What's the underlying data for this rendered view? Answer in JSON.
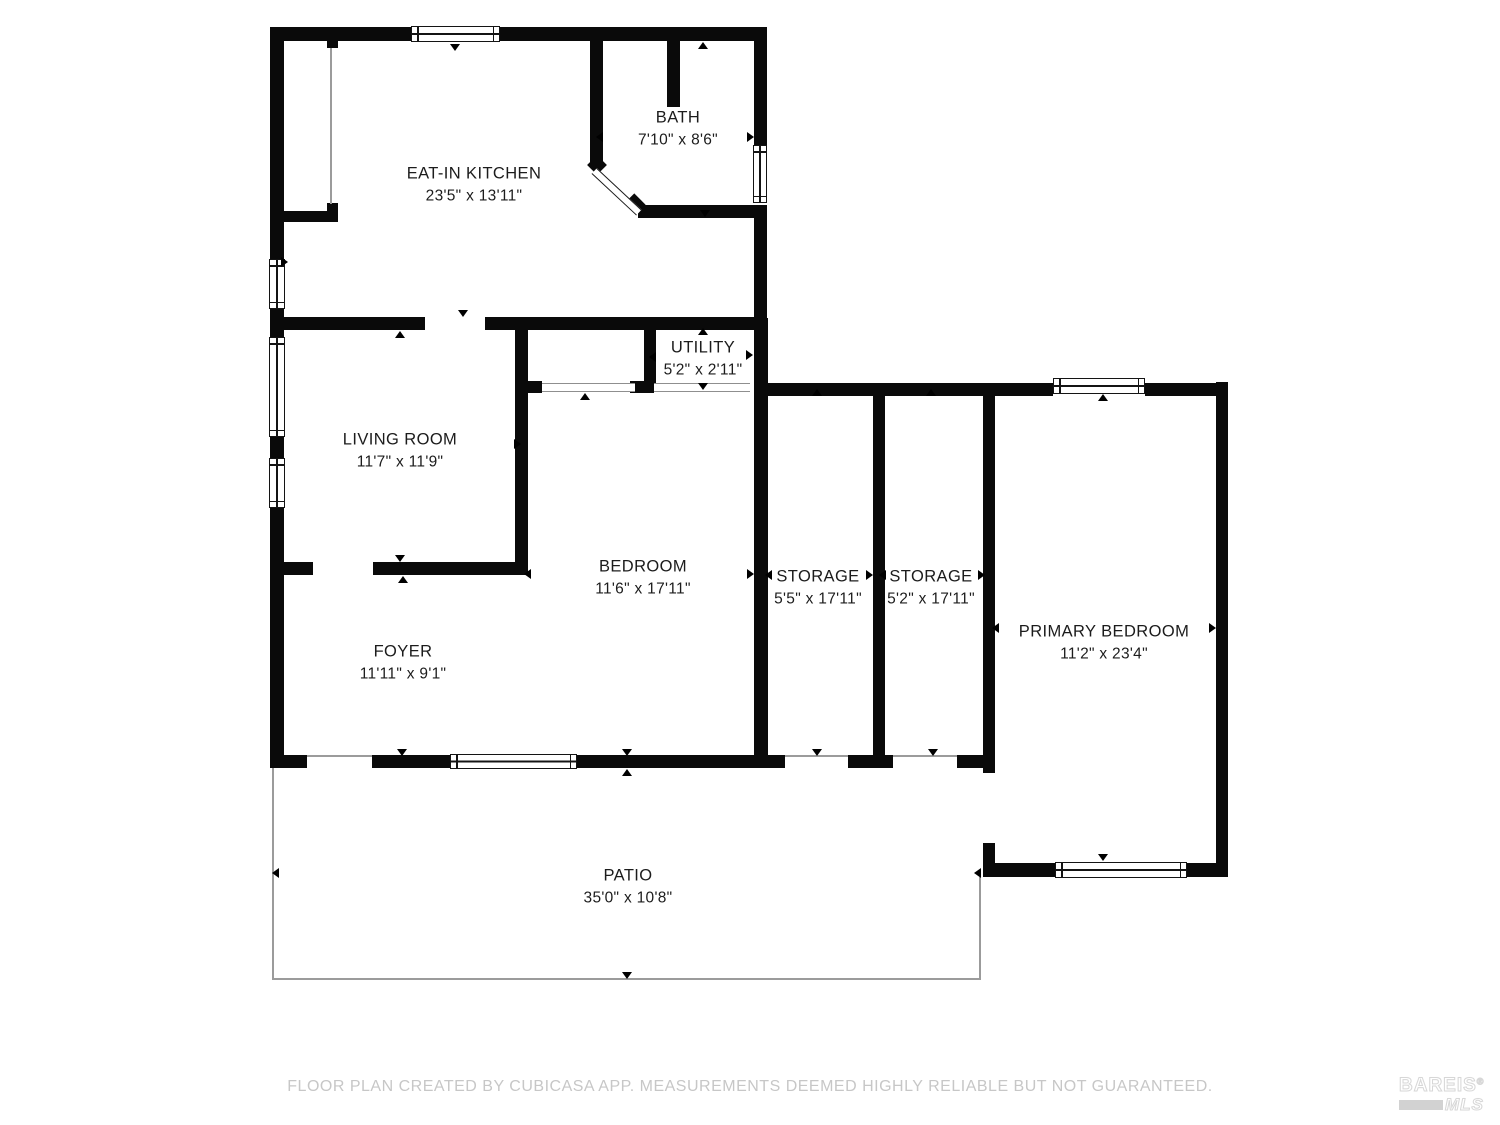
{
  "meta": {
    "width": 1500,
    "height": 1125,
    "background": "#ffffff",
    "wall_color": "#0a0a0a",
    "label_color": "#1c1c1c",
    "muted_line_color": "#9b9b9b",
    "footer_color": "#c7c7c7"
  },
  "rooms": [
    {
      "name": "EAT-IN KITCHEN",
      "dims": "23'5\" x 13'11\"",
      "cx": 474,
      "cy": 185
    },
    {
      "name": "BATH",
      "dims": "7'10\" x 8'6\"",
      "cx": 678,
      "cy": 129
    },
    {
      "name": "UTILITY",
      "dims": "5'2\" x 2'11\"",
      "cx": 703,
      "cy": 359
    },
    {
      "name": "LIVING ROOM",
      "dims": "11'7\" x 11'9\"",
      "cx": 400,
      "cy": 451
    },
    {
      "name": "BEDROOM",
      "dims": "11'6\" x 17'11\"",
      "cx": 643,
      "cy": 578
    },
    {
      "name": "STORAGE",
      "dims": "5'5\" x 17'11\"",
      "cx": 818,
      "cy": 588
    },
    {
      "name": "STORAGE",
      "dims": "5'2\" x 17'11\"",
      "cx": 931,
      "cy": 588
    },
    {
      "name": "PRIMARY BEDROOM",
      "dims": "11'2\" x 23'4\"",
      "cx": 1104,
      "cy": 643
    },
    {
      "name": "FOYER",
      "dims": "11'11\" x 9'1\"",
      "cx": 403,
      "cy": 663
    },
    {
      "name": "PATIO",
      "dims": "35'0\" x 10'8\"",
      "cx": 628,
      "cy": 887
    }
  ],
  "walls": [
    {
      "x": 270,
      "y": 27,
      "w": 497,
      "h": 14
    },
    {
      "x": 270,
      "y": 41,
      "w": 14,
      "h": 219
    },
    {
      "x": 270,
      "y": 307,
      "w": 14,
      "h": 11
    },
    {
      "x": 754,
      "y": 41,
      "w": 13,
      "h": 104
    },
    {
      "x": 754,
      "y": 205,
      "w": 13,
      "h": 113
    },
    {
      "x": 327,
      "y": 41,
      "w": 11,
      "h": 7
    },
    {
      "x": 327,
      "y": 203,
      "w": 11,
      "h": 9
    },
    {
      "x": 284,
      "y": 211,
      "w": 54,
      "h": 11
    },
    {
      "x": 590,
      "y": 41,
      "w": 13,
      "h": 127
    },
    {
      "x": 667,
      "y": 41,
      "w": 13,
      "h": 66
    },
    {
      "x": 638,
      "y": 205,
      "w": 116,
      "h": 13
    },
    {
      "x": 270,
      "y": 317,
      "w": 155,
      "h": 13
    },
    {
      "x": 485,
      "y": 317,
      "w": 269,
      "h": 13
    },
    {
      "x": 270,
      "y": 330,
      "w": 14,
      "h": 8
    },
    {
      "x": 270,
      "y": 435,
      "w": 14,
      "h": 23
    },
    {
      "x": 270,
      "y": 507,
      "w": 14,
      "h": 248
    },
    {
      "x": 515,
      "y": 330,
      "w": 13,
      "h": 245
    },
    {
      "x": 518,
      "y": 381,
      "w": 24,
      "h": 12
    },
    {
      "x": 630,
      "y": 381,
      "w": 24,
      "h": 12
    },
    {
      "x": 644,
      "y": 330,
      "w": 12,
      "h": 53
    },
    {
      "x": 754,
      "y": 318,
      "w": 14,
      "h": 450
    },
    {
      "x": 270,
      "y": 562,
      "w": 43,
      "h": 13
    },
    {
      "x": 373,
      "y": 562,
      "w": 144,
      "h": 13
    },
    {
      "x": 768,
      "y": 383,
      "w": 285,
      "h": 13
    },
    {
      "x": 1145,
      "y": 383,
      "w": 83,
      "h": 13
    },
    {
      "x": 873,
      "y": 390,
      "w": 12,
      "h": 378
    },
    {
      "x": 983,
      "y": 390,
      "w": 12,
      "h": 383
    },
    {
      "x": 983,
      "y": 843,
      "w": 12,
      "h": 34
    },
    {
      "x": 1216,
      "y": 382,
      "w": 12,
      "h": 495
    },
    {
      "x": 983,
      "y": 863,
      "w": 72,
      "h": 14
    },
    {
      "x": 1187,
      "y": 863,
      "w": 41,
      "h": 14
    },
    {
      "x": 270,
      "y": 755,
      "w": 37,
      "h": 13
    },
    {
      "x": 372,
      "y": 755,
      "w": 78,
      "h": 13
    },
    {
      "x": 577,
      "y": 755,
      "w": 208,
      "h": 13
    },
    {
      "x": 848,
      "y": 755,
      "w": 45,
      "h": 13
    },
    {
      "x": 957,
      "y": 755,
      "w": 36,
      "h": 13
    }
  ],
  "windows": [
    {
      "x": 411,
      "y": 26,
      "w": 89,
      "h": 16,
      "o": "h"
    },
    {
      "x": 753,
      "y": 145,
      "w": 14,
      "h": 58,
      "o": "v"
    },
    {
      "x": 269,
      "y": 259,
      "w": 16,
      "h": 50,
      "o": "v"
    },
    {
      "x": 269,
      "y": 337,
      "w": 16,
      "h": 100,
      "o": "v"
    },
    {
      "x": 269,
      "y": 458,
      "w": 16,
      "h": 50,
      "o": "v"
    },
    {
      "x": 450,
      "y": 754,
      "w": 127,
      "h": 15,
      "o": "h"
    },
    {
      "x": 1053,
      "y": 378,
      "w": 92,
      "h": 16,
      "o": "h"
    },
    {
      "x": 1055,
      "y": 862,
      "w": 132,
      "h": 16,
      "o": "h"
    }
  ],
  "openings": [
    {
      "x": 542,
      "y": 383,
      "w": 93,
      "h": 9
    },
    {
      "x": 654,
      "y": 383,
      "w": 96,
      "h": 9
    }
  ],
  "thin_lines": [
    {
      "x": 330,
      "y": 48,
      "w": 2,
      "h": 156
    },
    {
      "x": 307,
      "y": 755,
      "w": 65,
      "h": 2
    },
    {
      "x": 785,
      "y": 755,
      "w": 63,
      "h": 2
    },
    {
      "x": 893,
      "y": 755,
      "w": 64,
      "h": 2
    },
    {
      "x": 272,
      "y": 768,
      "w": 2,
      "h": 212
    },
    {
      "x": 272,
      "y": 978,
      "w": 709,
      "h": 2
    },
    {
      "x": 979,
      "y": 877,
      "w": 2,
      "h": 103
    }
  ],
  "arrows": [
    {
      "x": 455,
      "y": 47,
      "d": "down"
    },
    {
      "x": 703,
      "y": 45,
      "d": "up"
    },
    {
      "x": 599,
      "y": 137,
      "d": "left"
    },
    {
      "x": 750,
      "y": 137,
      "d": "right"
    },
    {
      "x": 705,
      "y": 213,
      "d": "down"
    },
    {
      "x": 284,
      "y": 262,
      "d": "right"
    },
    {
      "x": 463,
      "y": 313,
      "d": "down"
    },
    {
      "x": 400,
      "y": 334,
      "d": "up"
    },
    {
      "x": 517,
      "y": 444,
      "d": "right"
    },
    {
      "x": 400,
      "y": 558,
      "d": "down"
    },
    {
      "x": 403,
      "y": 579,
      "d": "up"
    },
    {
      "x": 527,
      "y": 574,
      "d": "left"
    },
    {
      "x": 750,
      "y": 574,
      "d": "right"
    },
    {
      "x": 585,
      "y": 396,
      "d": "up"
    },
    {
      "x": 652,
      "y": 357,
      "d": "left"
    },
    {
      "x": 749,
      "y": 355,
      "d": "right"
    },
    {
      "x": 703,
      "y": 331,
      "d": "up"
    },
    {
      "x": 703,
      "y": 386,
      "d": "down"
    },
    {
      "x": 768,
      "y": 575,
      "d": "left"
    },
    {
      "x": 869,
      "y": 575,
      "d": "right"
    },
    {
      "x": 817,
      "y": 392,
      "d": "up"
    },
    {
      "x": 882,
      "y": 575,
      "d": "left"
    },
    {
      "x": 981,
      "y": 575,
      "d": "right"
    },
    {
      "x": 931,
      "y": 392,
      "d": "up"
    },
    {
      "x": 995,
      "y": 628,
      "d": "left"
    },
    {
      "x": 1212,
      "y": 628,
      "d": "right"
    },
    {
      "x": 1103,
      "y": 397,
      "d": "up"
    },
    {
      "x": 1103,
      "y": 857,
      "d": "down"
    },
    {
      "x": 402,
      "y": 752,
      "d": "down"
    },
    {
      "x": 627,
      "y": 752,
      "d": "down"
    },
    {
      "x": 627,
      "y": 772,
      "d": "up"
    },
    {
      "x": 817,
      "y": 752,
      "d": "down"
    },
    {
      "x": 933,
      "y": 752,
      "d": "down"
    },
    {
      "x": 275,
      "y": 873,
      "d": "left"
    },
    {
      "x": 977,
      "y": 873,
      "d": "left"
    },
    {
      "x": 627,
      "y": 975,
      "d": "down"
    }
  ],
  "bath_door": {
    "x": 597,
    "y": 168,
    "len": 61,
    "thick": 8,
    "angle": 43,
    "caps": [
      {
        "x": 590,
        "y": 158,
        "w": 14,
        "h": 14
      },
      {
        "x": 627,
        "y": 197,
        "w": 16,
        "h": 14
      }
    ]
  },
  "footer": {
    "text": "FLOOR PLAN CREATED BY CUBICASA APP. MEASUREMENTS DEEMED HIGHLY RELIABLE BUT NOT GUARANTEED."
  },
  "logo": {
    "name": "BAREIS",
    "reg": "®",
    "sub": "MLS"
  }
}
